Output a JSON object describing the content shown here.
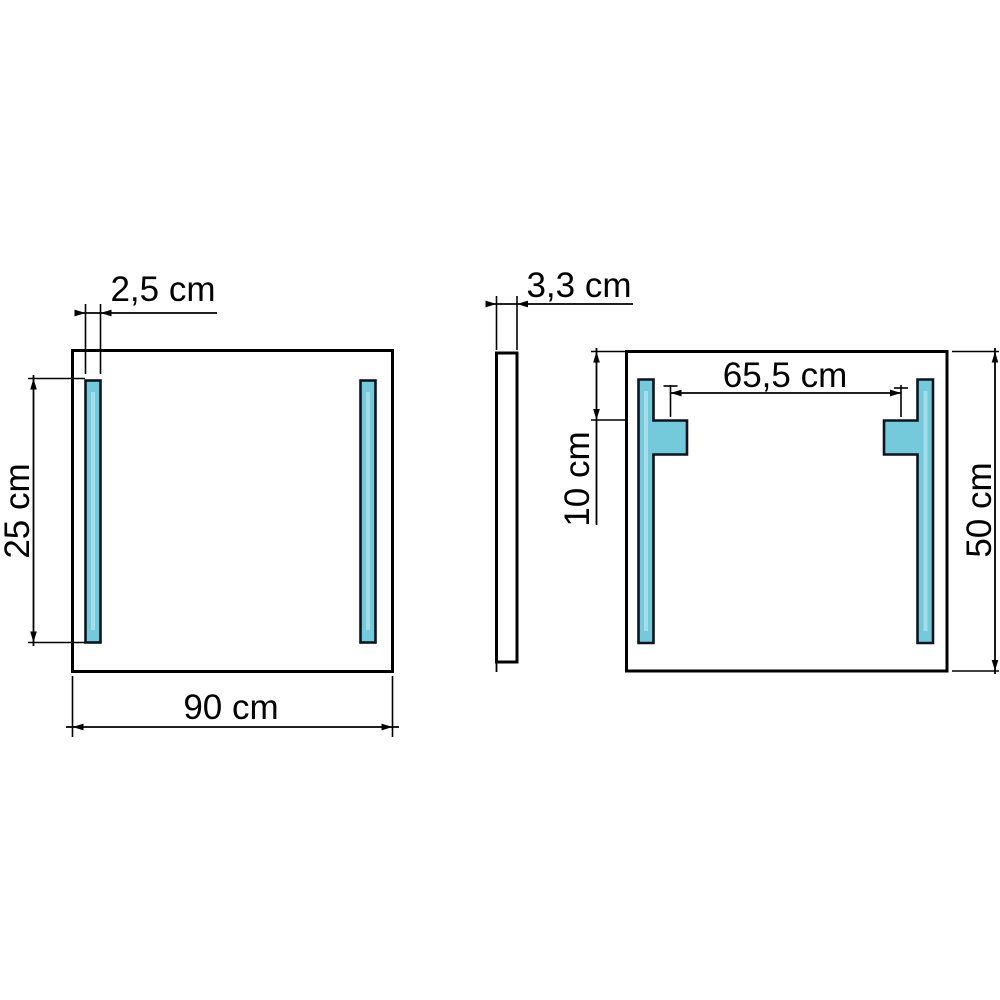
{
  "unit": "cm",
  "colors": {
    "highlight_fill": "#74c9da",
    "line": "#000000",
    "background": "#ffffff"
  },
  "views": {
    "front": {
      "dims": {
        "strip_width": "2,5 cm",
        "strip_height": "25 cm",
        "width": "90 cm"
      }
    },
    "side": {
      "dims": {
        "depth": "3,3 cm"
      }
    },
    "back": {
      "dims": {
        "bracket_spacing": "65,5 cm",
        "bracket_top_offset": "10 cm",
        "height": "50 cm"
      }
    }
  }
}
